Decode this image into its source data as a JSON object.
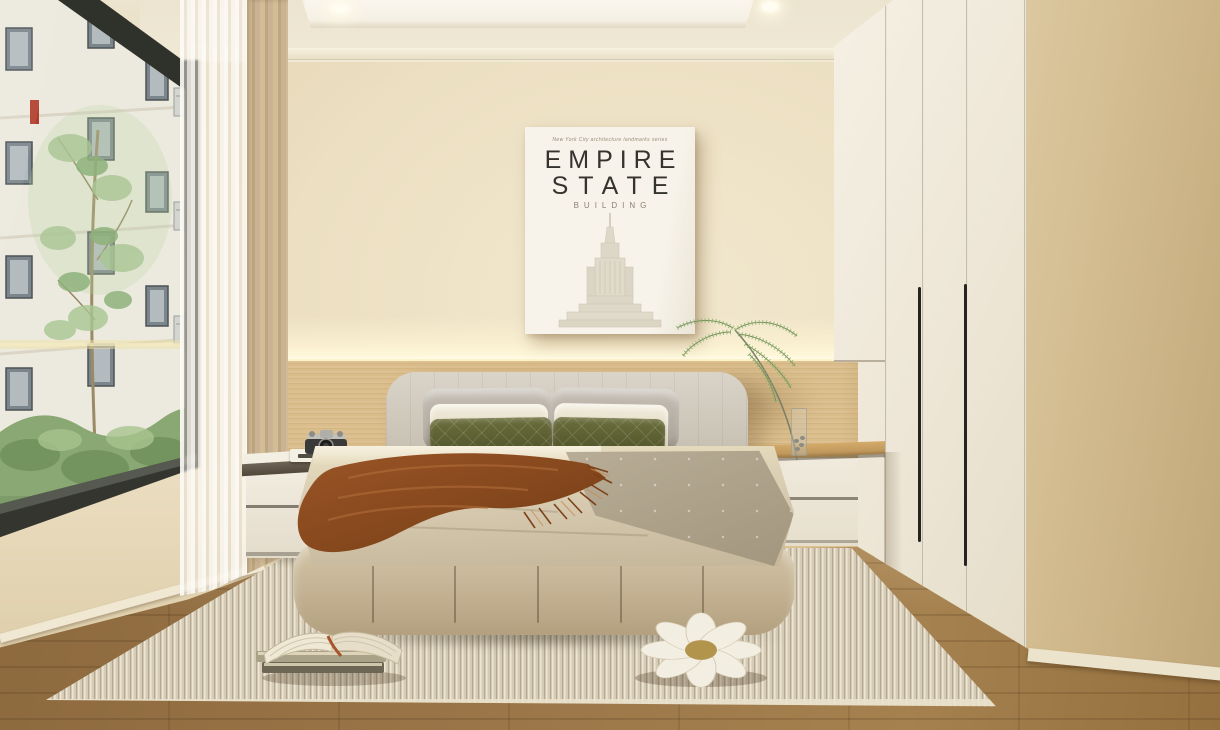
{
  "meta": {
    "description": "Minimalist cream japandi bedroom interior render with window view of an apartment courtyard",
    "room_type": "bedroom"
  },
  "poster": {
    "series_label": "New York City architecture landmarks series",
    "title_line_1": "EMPIRE",
    "title_line_2": "STATE",
    "subtitle": "BUILDING"
  },
  "palette": {
    "wall_cream": "#ecdfc2",
    "wood_slat_wall": "#d8bc8c",
    "led_glow": "#fff7da",
    "ceiling_white": "#f9f5ec",
    "right_wall_tan": "#d0b98c",
    "wardrobe_cream": "#efe8d9",
    "floor_wood": "#9a7548",
    "rug_cream": "#ded4bd",
    "bed_frame_beige": "#c3b192",
    "duvet_cream": "#d4c7ad",
    "duvet_gray_flap": "#b0a48c",
    "pillow_olive": "#5c5f31",
    "pillow_gray": "#b5aea2",
    "throw_rust": "#8a4a20",
    "window_frame_black": "#2f312b",
    "view_building": "#ece8e0",
    "view_foliage": "#93b27e",
    "vase_fern_green": "#7d9c60",
    "counter_oak": "#c89f60",
    "nightstand_white": "#efe9dd",
    "pouf_white": "#f3eee2",
    "accent_red_in_window": "#b23d2a",
    "center_of_pouf_brass": "#b2944c"
  },
  "scene_objects": [
    "window-city-view",
    "sheer-curtain",
    "beige-curtain",
    "empire-state-poster",
    "led-cove-light",
    "wood-slat-accent-wall",
    "recessed-spotlights",
    "built-in-wardrobe",
    "upholstered-bed",
    "olive-velvet-pillows",
    "rust-throw-blanket",
    "left-nightstand",
    "vintage-camera",
    "white-book",
    "right-nightstand-counter",
    "glass-vase-with-fern",
    "ribbed-area-rug",
    "open-book-stack",
    "daisy-flower-pouf",
    "oak-floor"
  ]
}
